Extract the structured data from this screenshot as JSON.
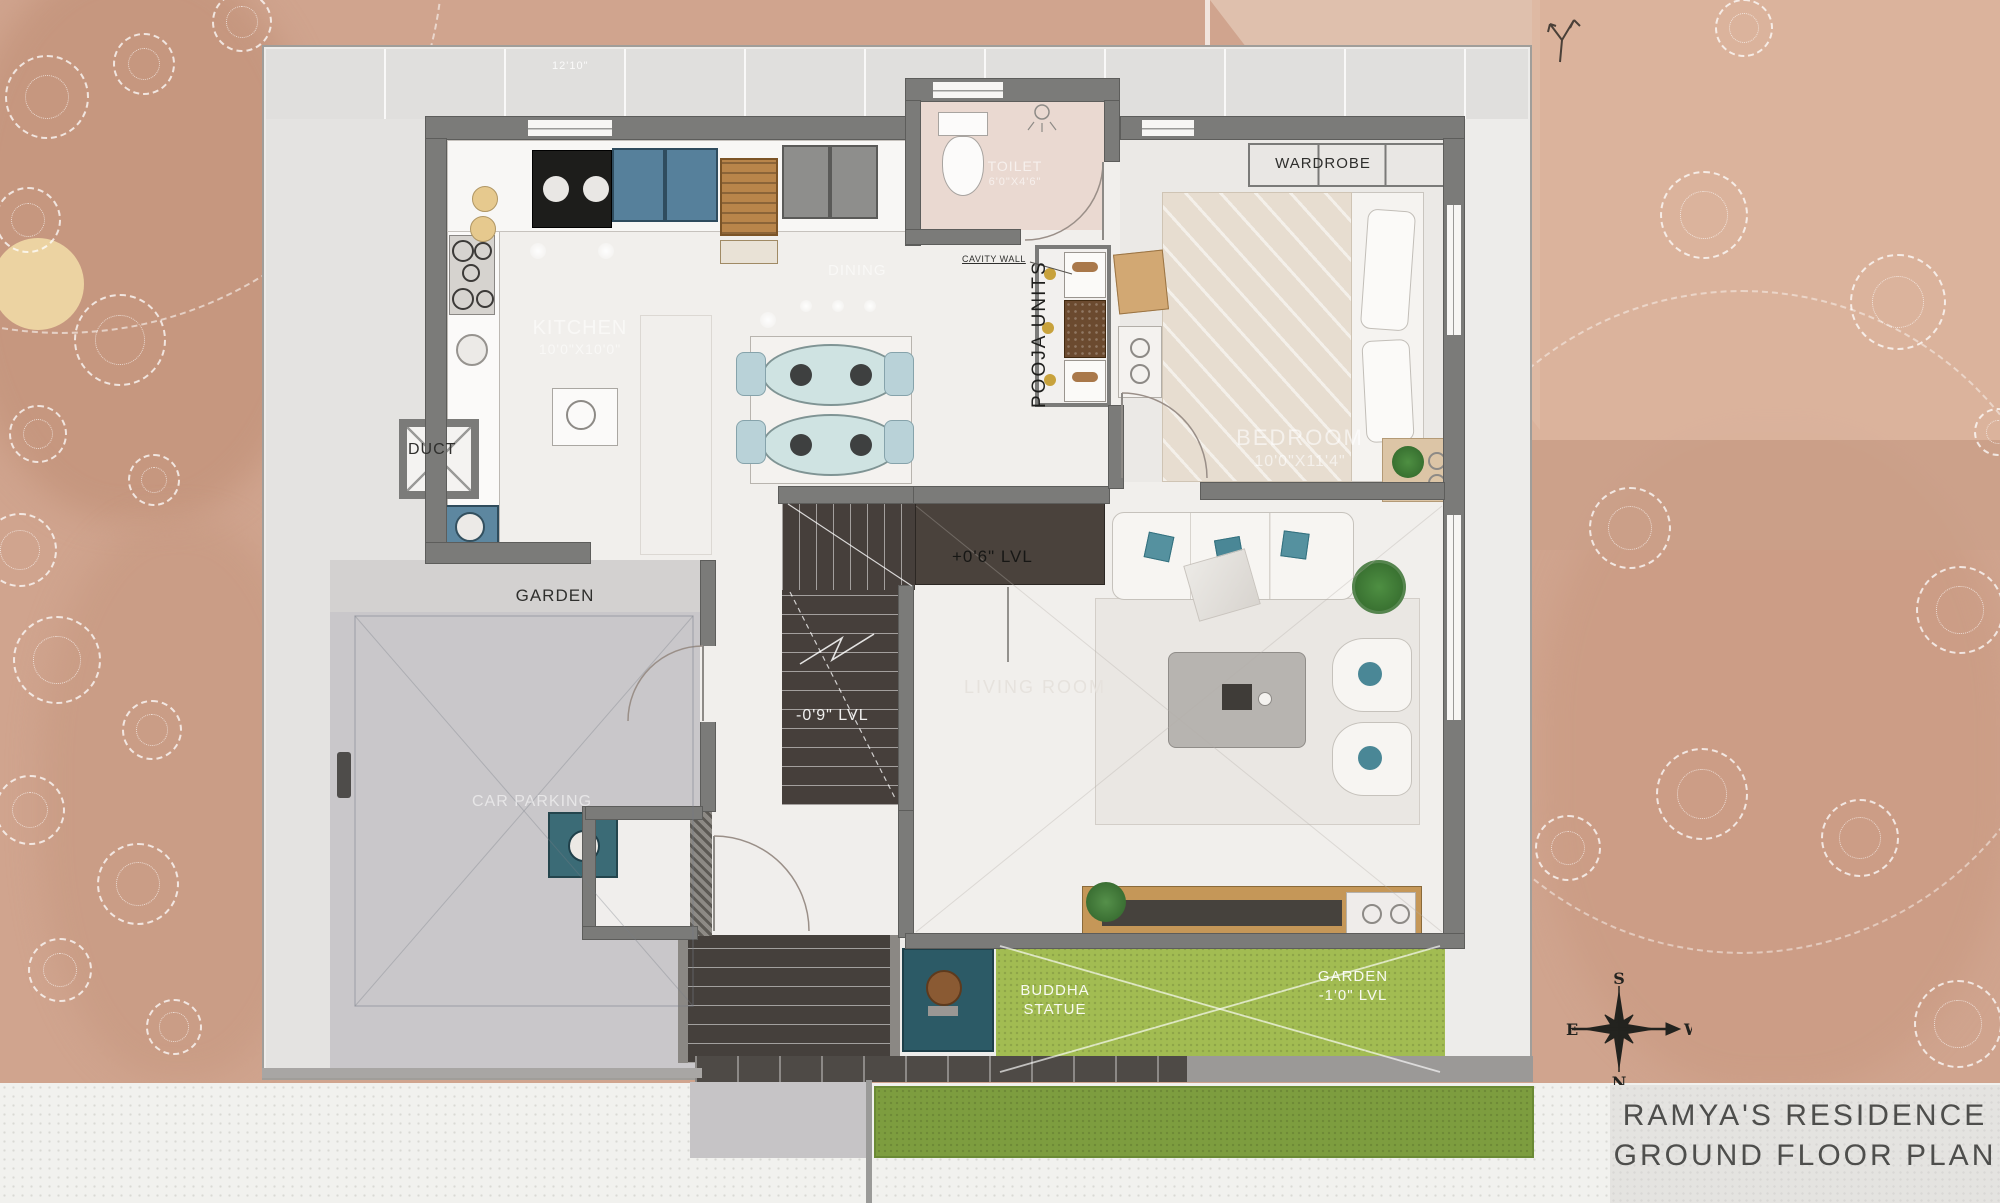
{
  "title_block": {
    "line1": "RAMYA'S RESIDENCE",
    "line2": "GROUND FLOOR PLAN"
  },
  "compass": {
    "north": "N",
    "south": "S",
    "east": "E",
    "west": "W"
  },
  "labels": {
    "wardrobe": "WARDROBE",
    "duct": "DUCT",
    "garden": "GARDEN",
    "car_parking": "CAR PARKING",
    "pooja_units": "POOJA UNITS",
    "cavity_wall": "CAVITY WALL",
    "level_plus": "+0'6\" LVL",
    "level_minus": "-0'9\" LVL",
    "buddha_statue": "BUDDHA\nSTATUE",
    "garden_level": "GARDEN\n-1'0\" LVL",
    "top_dimension": "12'10\""
  },
  "rooms": {
    "kitchen": {
      "name": "KITCHEN",
      "dims": "10'0\"X10'0\""
    },
    "toilet": {
      "name": "TOILET",
      "dims": "6'0\"X4'6\""
    },
    "bedroom": {
      "name": "BEDROOM",
      "dims": "10'0\"X11'4\""
    },
    "dining": {
      "name": "DINING"
    },
    "living": {
      "name": "LIVING ROOM"
    }
  },
  "colors": {
    "site_salmon": "#d0a48e",
    "wall_gray": "#7b7b79",
    "stair_dark": "#463f3b",
    "garden_green": "#a2bc52",
    "grass_dark": "#7d9d3f",
    "parking_gray": "#c9c7ca",
    "pooja_teal": "#2c5a66",
    "cabinet_blue": "#56809b"
  }
}
